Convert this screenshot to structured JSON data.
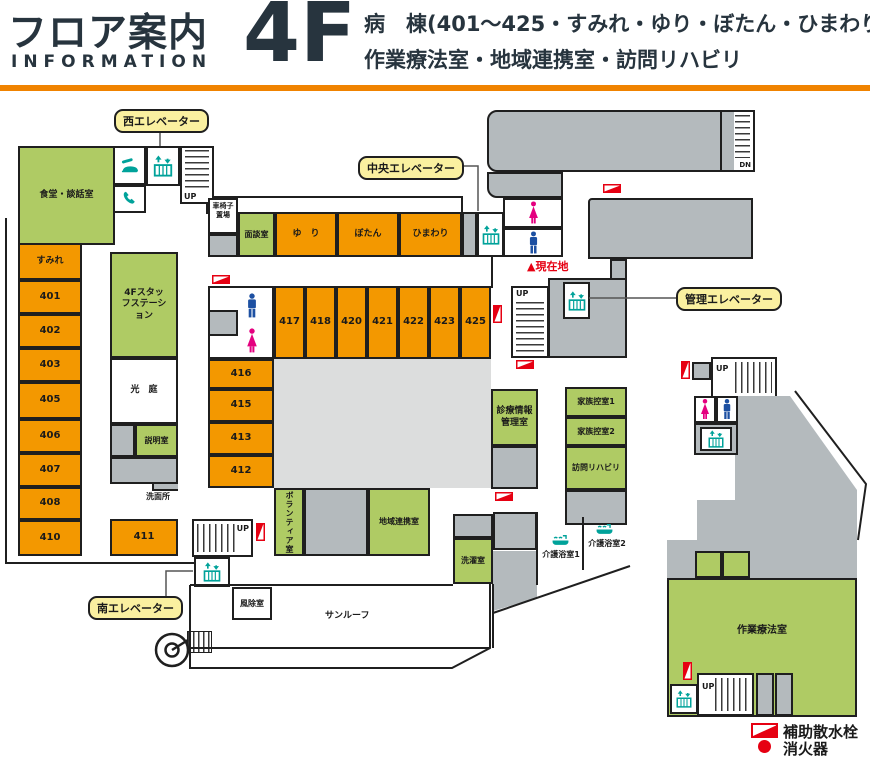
{
  "header": {
    "title_jp": "フロア案内",
    "title_en": "INFORMATION",
    "floor": "4F",
    "desc_line1": "病　棟(401〜425・すみれ・ゆり・ぼたん・ひまわり)",
    "desc_line2": "作業療法室・地域連携室・訪問リハビリ"
  },
  "callouts": {
    "west": "西エレベーター",
    "central": "中央エレベーター",
    "admin": "管理エレベーター",
    "south": "南エレベーター"
  },
  "marker": {
    "current_location": "▲現在地"
  },
  "stair_labels": {
    "up": "UP",
    "dn": "DN"
  },
  "rooms": {
    "dining": "食堂・談話室",
    "sumire": "すみれ",
    "r401": "401",
    "r402": "402",
    "r403": "403",
    "r405": "405",
    "r406": "406",
    "r407": "407",
    "r408": "408",
    "r410": "410",
    "r411": "411",
    "r412": "412",
    "r413": "413",
    "r415": "415",
    "r416": "416",
    "r417": "417",
    "r418": "418",
    "r420": "420",
    "r421": "421",
    "r422": "422",
    "r423": "423",
    "r425": "425",
    "staff_station": "4Fスタッフステーション",
    "light_garden": "光　庭",
    "setsumei": "説明室",
    "senmenjo": "洗面所",
    "wheelchair": "車椅子置場",
    "mendan": "面談室",
    "yuri": "ゆ　り",
    "botan": "ぼたん",
    "himawari": "ひまわり",
    "volunteer": "ボランティア室",
    "chiiki": "地域連携室",
    "fujo": "風除室",
    "sunroof": "サンルーフ",
    "laundry": "洗濯室",
    "shinryo": "診療情報管理室",
    "kazoku1": "家族控室1",
    "kazoku2": "家族控室2",
    "homon": "訪問リハビリ",
    "kaigo1": "介護浴室1",
    "kaigo2": "介護浴室2",
    "sagyo": "作業療法室"
  },
  "legend": {
    "hydrant": "補助散水栓",
    "extinguisher": "消火器"
  },
  "colors": {
    "room_orange": "#F39800",
    "room_green": "#AFCB64",
    "room_gray": "#B4BABD",
    "courtyard_gray": "#DCDDDD",
    "accent_red": "#E60012",
    "icon_teal": "#00A29A",
    "male_blue": "#1D50A2",
    "female_pink": "#E4007F",
    "callout_yellow": "#FAF0A0",
    "header_rule_orange": "#F08300",
    "header_text": "#27343E"
  }
}
